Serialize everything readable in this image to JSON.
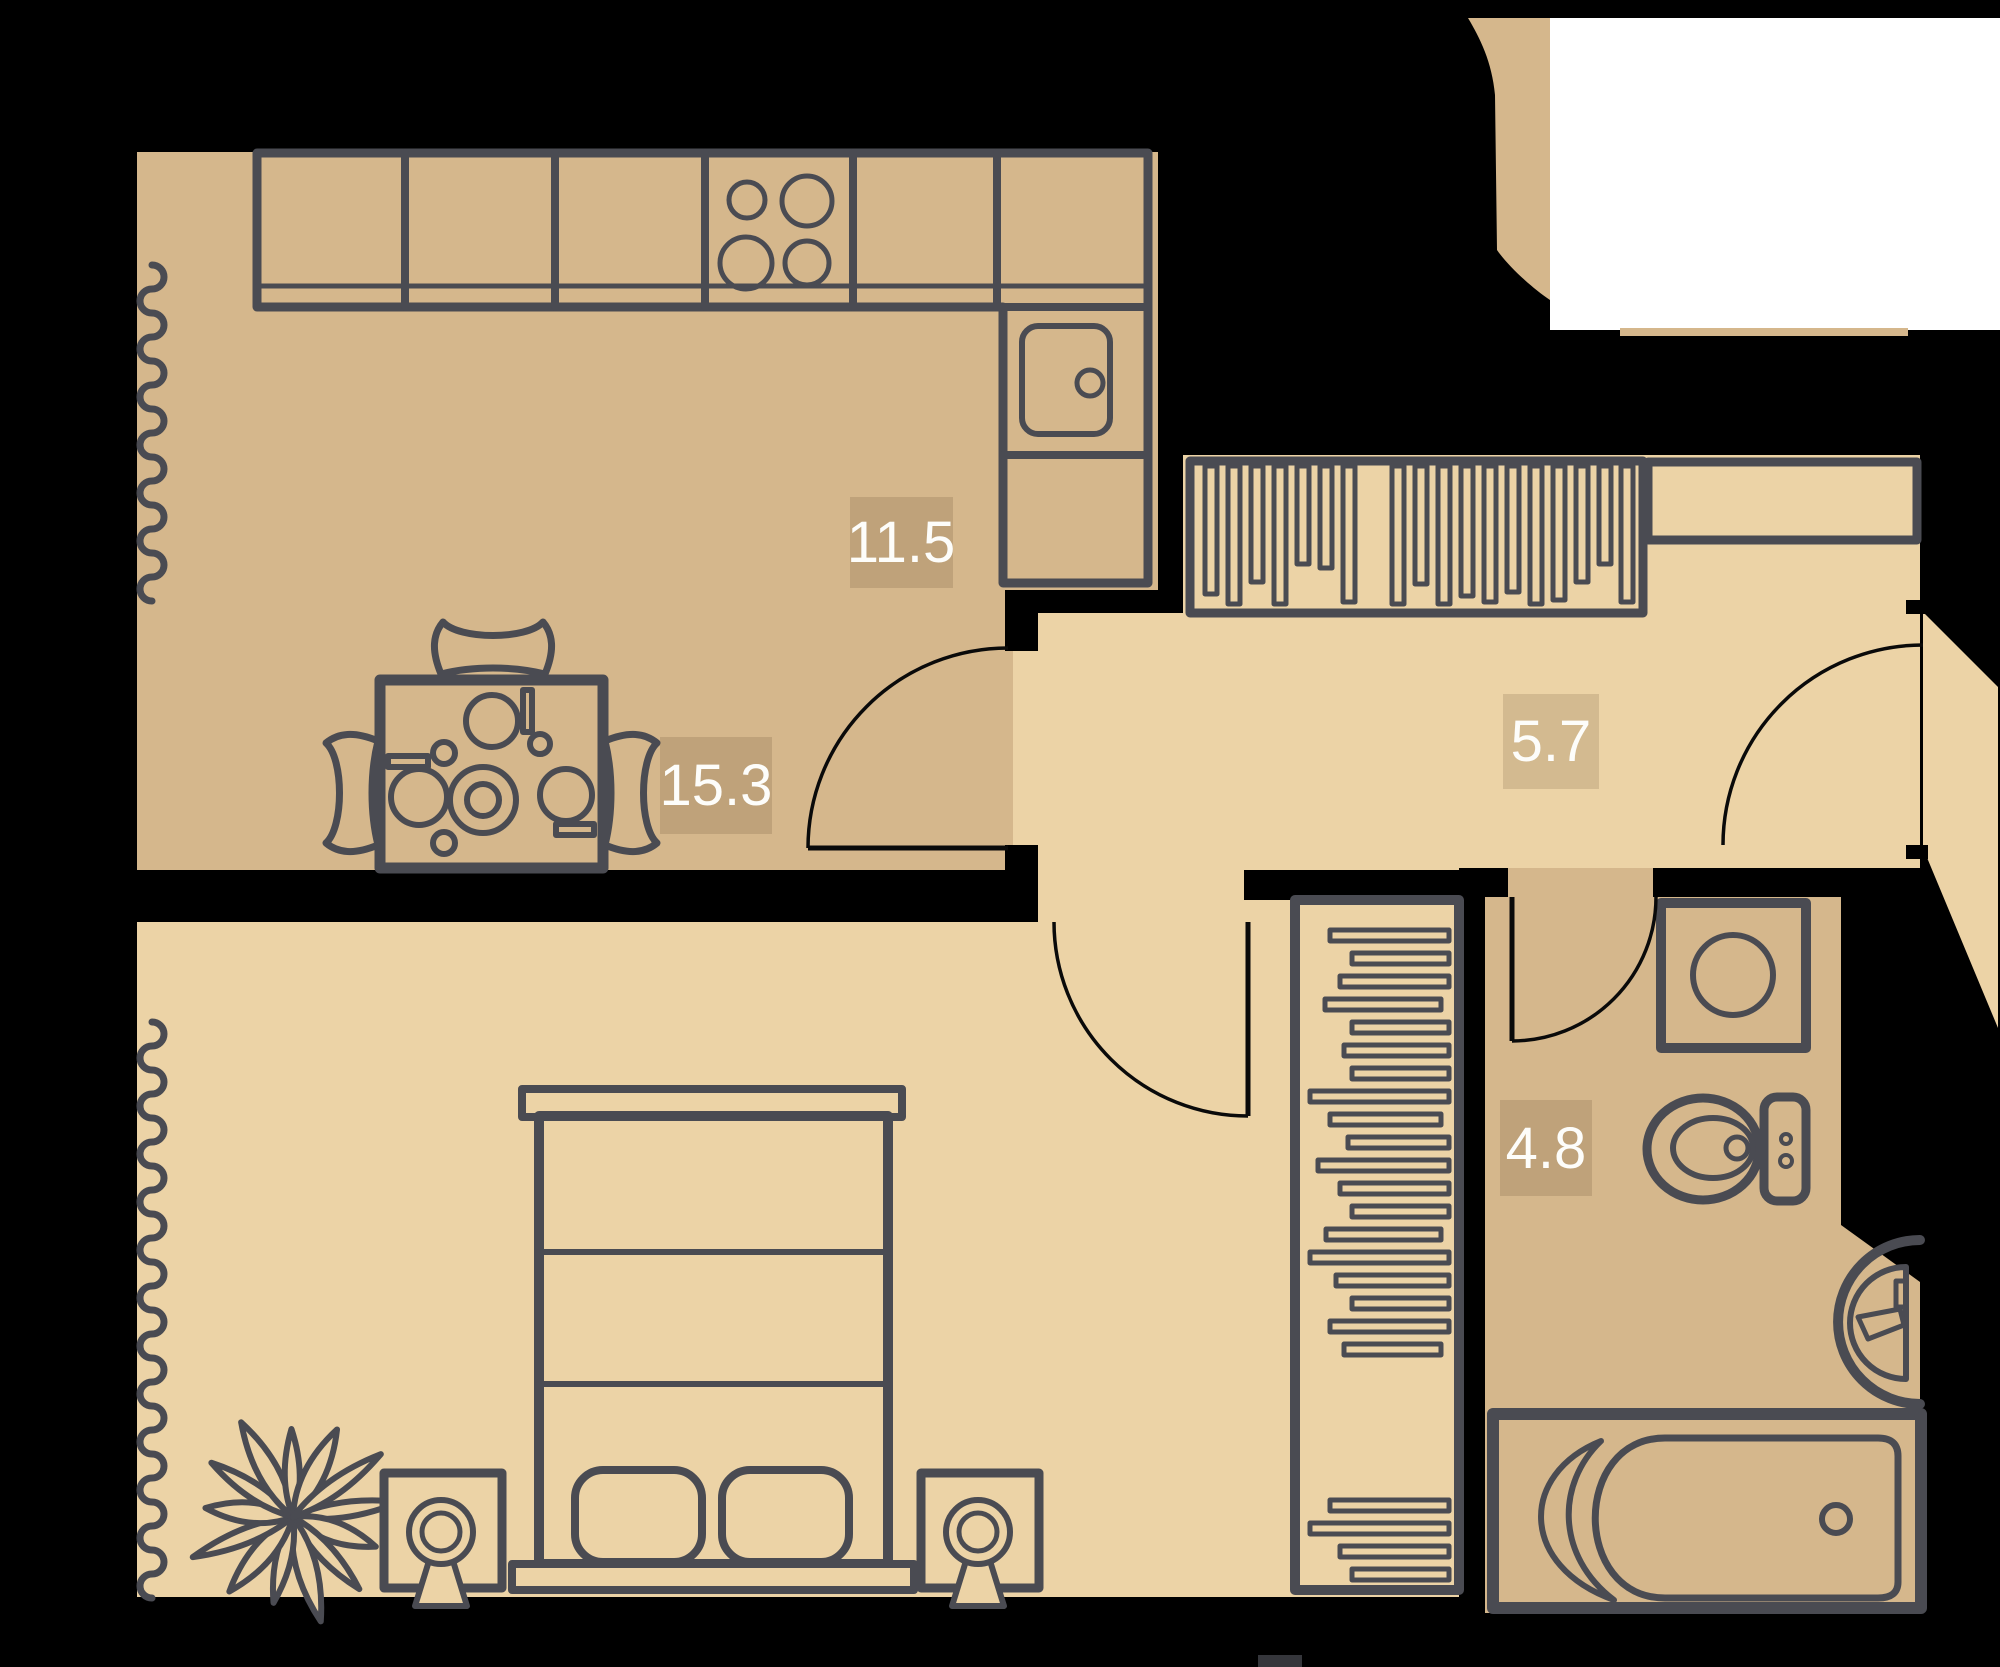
{
  "plan": {
    "rooms": [
      {
        "id": "kitchen",
        "area_label": "11.5"
      },
      {
        "id": "hallway",
        "area_label": "5.7"
      },
      {
        "id": "bedroom",
        "area_label": "15.3"
      },
      {
        "id": "bathroom",
        "area_label": "4.8"
      }
    ]
  },
  "colors": {
    "background": "#000000",
    "room_dark": "#d5b78c",
    "room_light": "#ecd3a6",
    "furniture_stroke": "#4a4b52",
    "door_stroke": "#0a0a0a",
    "label_text": "#fdfdfa",
    "label_badge": "rgba(80,55,30,0.16)",
    "adjacent_white": "#ffffff"
  }
}
